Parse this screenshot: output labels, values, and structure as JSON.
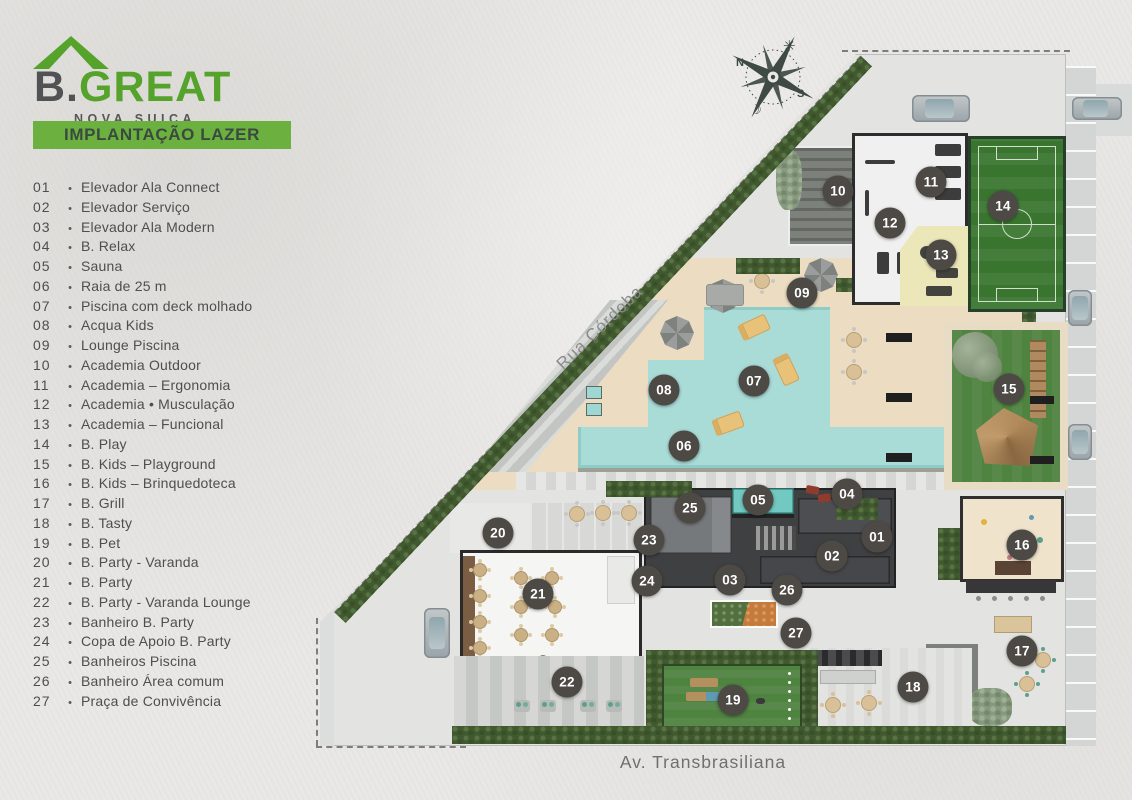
{
  "brand": {
    "logo_b": "B.",
    "logo_great": "GREAT",
    "subtitle": "NOVA SUIÇA"
  },
  "banner": {
    "title": "IMPLANTAÇÃO LAZER"
  },
  "legend": [
    {
      "num": "01",
      "label": "Elevador Ala Connect"
    },
    {
      "num": "02",
      "label": "Elevador Serviço"
    },
    {
      "num": "03",
      "label": "Elevador Ala Modern"
    },
    {
      "num": "04",
      "label": "B. Relax"
    },
    {
      "num": "05",
      "label": "Sauna"
    },
    {
      "num": "06",
      "label": "Raia de 25 m"
    },
    {
      "num": "07",
      "label": "Piscina com deck molhado"
    },
    {
      "num": "08",
      "label": "Acqua Kids"
    },
    {
      "num": "09",
      "label": "Lounge Piscina"
    },
    {
      "num": "10",
      "label": "Academia Outdoor"
    },
    {
      "num": "11",
      "label": "Academia – Ergonomia"
    },
    {
      "num": "12",
      "label": "Academia • Musculação"
    },
    {
      "num": "13",
      "label": "Academia – Funcional"
    },
    {
      "num": "14",
      "label": "B. Play"
    },
    {
      "num": "15",
      "label": "B. Kids – Playground"
    },
    {
      "num": "16",
      "label": "B. Kids – Brinquedoteca"
    },
    {
      "num": "17",
      "label": "B. Grill"
    },
    {
      "num": "18",
      "label": "B. Tasty"
    },
    {
      "num": "19",
      "label": "B. Pet"
    },
    {
      "num": "20",
      "label": "B. Party - Varanda"
    },
    {
      "num": "21",
      "label": "B. Party"
    },
    {
      "num": "22",
      "label": "B. Party - Varanda Lounge"
    },
    {
      "num": "23",
      "label": "Banheiro B. Party"
    },
    {
      "num": "24",
      "label": "Copa de Apoio B. Party"
    },
    {
      "num": "25",
      "label": "Banheiros Piscina"
    },
    {
      "num": "26",
      "label": "Banheiro Área comum"
    },
    {
      "num": "27",
      "label": "Praça de Convivência"
    }
  ],
  "streets": {
    "diagonal": "Rua Córdoba",
    "bottom": "Av. Transbrasiliana"
  },
  "compass": {
    "north": "N",
    "south": "S",
    "sun_icon": "✳",
    "moon_icon": "☽"
  },
  "markers": [
    {
      "num": "01",
      "x": 877,
      "y": 537
    },
    {
      "num": "02",
      "x": 832,
      "y": 556
    },
    {
      "num": "03",
      "x": 730,
      "y": 580
    },
    {
      "num": "04",
      "x": 847,
      "y": 494
    },
    {
      "num": "05",
      "x": 758,
      "y": 500
    },
    {
      "num": "06",
      "x": 684,
      "y": 446
    },
    {
      "num": "07",
      "x": 754,
      "y": 381
    },
    {
      "num": "08",
      "x": 664,
      "y": 390
    },
    {
      "num": "09",
      "x": 802,
      "y": 293
    },
    {
      "num": "10",
      "x": 838,
      "y": 191
    },
    {
      "num": "11",
      "x": 931,
      "y": 182
    },
    {
      "num": "12",
      "x": 890,
      "y": 223
    },
    {
      "num": "13",
      "x": 941,
      "y": 255
    },
    {
      "num": "14",
      "x": 1003,
      "y": 206
    },
    {
      "num": "15",
      "x": 1009,
      "y": 389
    },
    {
      "num": "16",
      "x": 1022,
      "y": 545
    },
    {
      "num": "17",
      "x": 1022,
      "y": 651
    },
    {
      "num": "18",
      "x": 913,
      "y": 687
    },
    {
      "num": "19",
      "x": 733,
      "y": 700
    },
    {
      "num": "20",
      "x": 498,
      "y": 533
    },
    {
      "num": "21",
      "x": 538,
      "y": 594
    },
    {
      "num": "22",
      "x": 567,
      "y": 682
    },
    {
      "num": "23",
      "x": 649,
      "y": 540
    },
    {
      "num": "24",
      "x": 647,
      "y": 581
    },
    {
      "num": "25",
      "x": 690,
      "y": 508
    },
    {
      "num": "26",
      "x": 787,
      "y": 590
    },
    {
      "num": "27",
      "x": 796,
      "y": 633
    }
  ],
  "colors": {
    "paper": "#e9e8e6",
    "accent_green": "#6cb13f",
    "logo_green": "#55a32b",
    "ink": "#4e4e4e",
    "marker_bg": "#4d4a46",
    "marker_text": "#ffffff",
    "pool": "#a9dbd7",
    "sand": "#ecdcc2",
    "court_green": "#39752f",
    "lawn_green": "#4f8340",
    "hedge_green": "#42592f",
    "building_dark": "#3f4041",
    "road_gray": "#d5d7d6",
    "paving": "#e3e4e2"
  }
}
